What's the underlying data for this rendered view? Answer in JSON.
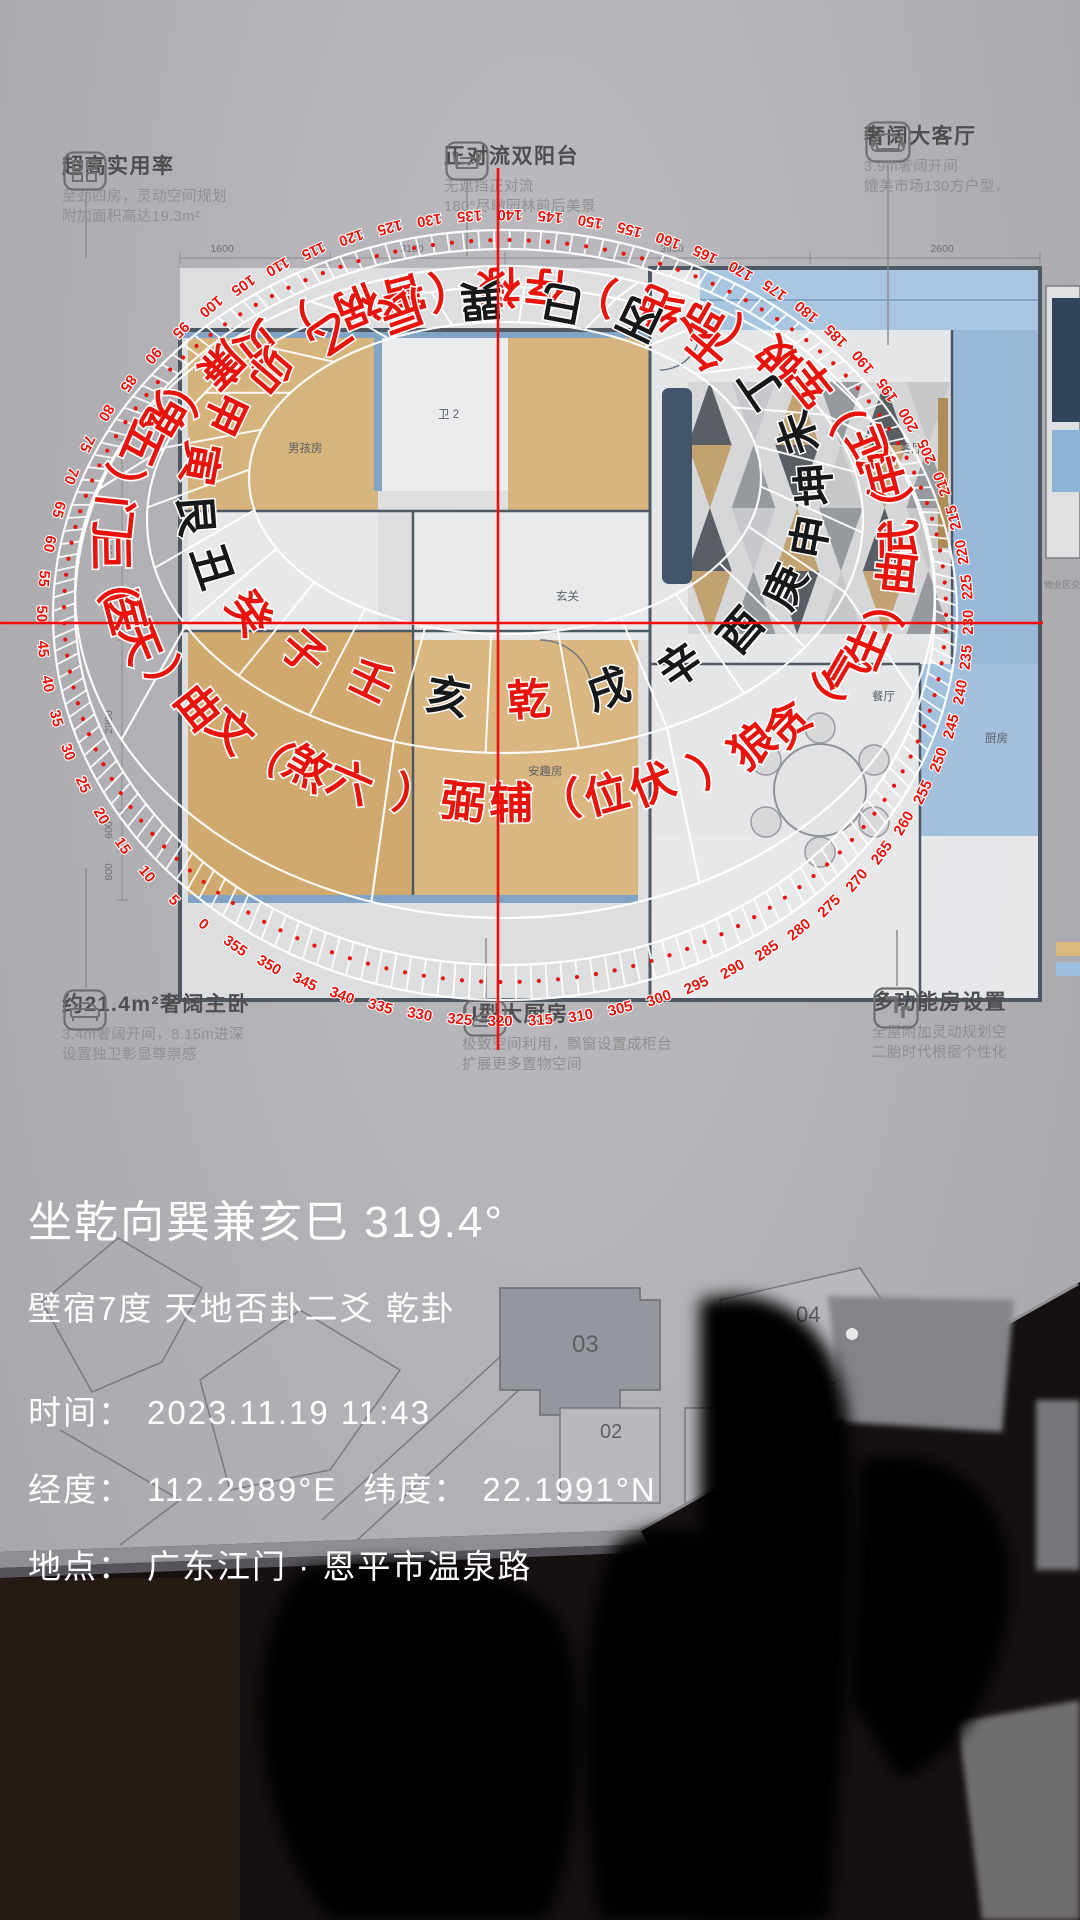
{
  "overlay": {
    "heading_line": "坐乾向巽兼亥巳 319.4°",
    "detail_line": "壁宿7度 天地否卦二爻 乾卦",
    "time_label": "时间：",
    "time_value": "2023.11.19 11:43",
    "lon_label": "经度：",
    "lon_value": "112.2989°E",
    "lat_label": "纬度：",
    "lat_value": "22.1991°N",
    "loc_label": "地点：",
    "loc_value": "广东江门 · 恩平市温泉路"
  },
  "compass": {
    "heading_deg": 319.4,
    "top_deg": 139.4,
    "degree_label_step": 5,
    "red": "#e8140c",
    "black": "#17181a",
    "mountains": [
      {
        "name": "子",
        "deg": 0,
        "color": "red"
      },
      {
        "name": "癸",
        "deg": 15,
        "color": "red"
      },
      {
        "name": "丑",
        "deg": 30,
        "color": "black"
      },
      {
        "name": "艮",
        "deg": 45,
        "color": "black"
      },
      {
        "name": "寅",
        "deg": 60,
        "color": "red"
      },
      {
        "name": "甲",
        "deg": 75,
        "color": "red"
      },
      {
        "name": "卯",
        "deg": 90,
        "color": "red"
      },
      {
        "name": "乙",
        "deg": 105,
        "color": "red"
      },
      {
        "name": "辰",
        "deg": 120,
        "color": "red"
      },
      {
        "name": "巽",
        "deg": 135,
        "color": "black"
      },
      {
        "name": "巳",
        "deg": 150,
        "color": "black"
      },
      {
        "name": "丙",
        "deg": 165,
        "color": "black"
      },
      {
        "name": "午",
        "deg": 180,
        "color": "red"
      },
      {
        "name": "丁",
        "deg": 195,
        "color": "black"
      },
      {
        "name": "未",
        "deg": 210,
        "color": "black"
      },
      {
        "name": "坤",
        "deg": 225,
        "color": "black"
      },
      {
        "name": "申",
        "deg": 240,
        "color": "black"
      },
      {
        "name": "庚",
        "deg": 255,
        "color": "black"
      },
      {
        "name": "酉",
        "deg": 270,
        "color": "black"
      },
      {
        "name": "辛",
        "deg": 285,
        "color": "black"
      },
      {
        "name": "戌",
        "deg": 300,
        "color": "black"
      },
      {
        "name": "乾",
        "deg": 315,
        "color": "red"
      },
      {
        "name": "亥",
        "deg": 330,
        "color": "black"
      },
      {
        "name": "壬",
        "deg": 345,
        "color": "red"
      }
    ],
    "stars": [
      {
        "name": "六煞",
        "bracket": "（文曲）",
        "deg": 0
      },
      {
        "name": "天医",
        "bracket": "（巨门）",
        "deg": 45
      },
      {
        "name": "五鬼",
        "bracket": "（廉贞）",
        "deg": 90
      },
      {
        "name": "祸害",
        "bracket": "（禄存）",
        "deg": 135
      },
      {
        "name": "绝命",
        "bracket": "（破军）",
        "deg": 180
      },
      {
        "name": "延年",
        "bracket": "（武曲）",
        "deg": 225
      },
      {
        "name": "生气",
        "bracket": "（贪狼）",
        "deg": 270
      },
      {
        "name": "伏位",
        "bracket": "（辅弼）",
        "deg": 315
      }
    ]
  },
  "brochure": {
    "callouts": [
      {
        "icon": "grid-icon",
        "title": "超高实用率",
        "line1": "至劲四房，灵动空间规划",
        "line2": "附加面积高达19.3m²"
      },
      {
        "icon": "window-icon",
        "title": "正对流双阳台",
        "line1": "无遮挡正对流",
        "line2": "180°尽瞰园林前后美景"
      },
      {
        "icon": "sofa-icon",
        "title": "奢阔大客厅",
        "line1": "3.9m奢阔开间",
        "line2": "媲美市场130方户型，"
      },
      {
        "icon": "bed-icon",
        "title": "约21.4m²奢阔主卧",
        "line1": "3.4m奢阔开间，8.15m进深",
        "line2": "设置独卫彰显尊崇感"
      },
      {
        "icon": "kitchen-icon",
        "title": "U型大厨房",
        "line1": "极致空间利用，飘窗设置成柜台",
        "line2": "扩展更多置物空间"
      },
      {
        "icon": "room-icon",
        "title": "多功能房设置",
        "line1": "全屋附加灵动规划空",
        "line2": "二胎时代根据个性化"
      }
    ],
    "floorplan_labels": [
      {
        "text": "男孩房",
        "x": 288,
        "y": 452
      },
      {
        "text": "卫 2",
        "x": 438,
        "y": 418
      },
      {
        "text": "玄关",
        "x": 556,
        "y": 600
      },
      {
        "text": "安趣房",
        "x": 528,
        "y": 775
      },
      {
        "text": "客厅",
        "x": 900,
        "y": 452
      },
      {
        "text": "餐厅",
        "x": 872,
        "y": 700
      },
      {
        "text": "厨房",
        "x": 985,
        "y": 742
      }
    ],
    "dimensions_top": [
      {
        "text": "1600",
        "x": 222
      },
      {
        "text": "3100",
        "x": 412
      },
      {
        "text": "3900",
        "x": 672
      },
      {
        "text": "2600",
        "x": 942
      }
    ],
    "dimensions_left": [
      {
        "text": "1800",
        "y": 556
      },
      {
        "text": "2900",
        "y": 722
      },
      {
        "text": "600",
        "y": 830
      },
      {
        "text": "800",
        "y": 872
      }
    ],
    "siteplan_labels": [
      {
        "text": "03",
        "x": 572,
        "y": 1352,
        "fs": 24
      },
      {
        "text": "04",
        "x": 796,
        "y": 1322,
        "fs": 22
      },
      {
        "text": "02",
        "x": 600,
        "y": 1438,
        "fs": 20
      },
      {
        "text": "01",
        "x": 730,
        "y": 1438,
        "fs": 20
      }
    ],
    "side_caption": "物业区交付标准"
  }
}
